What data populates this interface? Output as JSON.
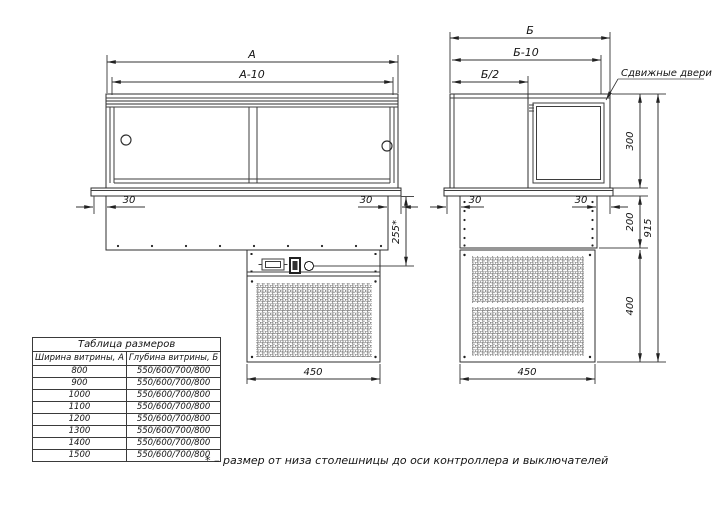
{
  "colors": {
    "background": "#ffffff",
    "line": "#2e2e2e",
    "text": "#141414"
  },
  "front_view": {
    "dim_a": "А",
    "dim_a10": "А-10",
    "dim_30_left": "30",
    "dim_30_right": "30",
    "dim_255": "255*",
    "dim_450": "450"
  },
  "side_view": {
    "dim_b": "Б",
    "dim_b10": "Б-10",
    "dim_b2": "Б/2",
    "sliding_doors_label": "Сдвижные двери",
    "dim_30_left": "30",
    "dim_30_right": "30",
    "dim_300": "300",
    "dim_200": "200",
    "dim_400": "400",
    "dim_915": "915",
    "dim_450": "450"
  },
  "size_table": {
    "title": "Таблица размеров",
    "col_a": "Ширина витрины, А",
    "col_b": "Глубина витрины, Б",
    "rows": [
      {
        "a": "800",
        "b": "550/600/700/800"
      },
      {
        "a": "900",
        "b": "550/600/700/800"
      },
      {
        "a": "1000",
        "b": "550/600/700/800"
      },
      {
        "a": "1100",
        "b": "550/600/700/800"
      },
      {
        "a": "1200",
        "b": "550/600/700/800"
      },
      {
        "a": "1300",
        "b": "550/600/700/800"
      },
      {
        "a": "1400",
        "b": "550/600/700/800"
      },
      {
        "a": "1500",
        "b": "550/600/700/800"
      }
    ]
  },
  "footnote": "* – размер от низа столешницы до оси контроллера и выключателей"
}
